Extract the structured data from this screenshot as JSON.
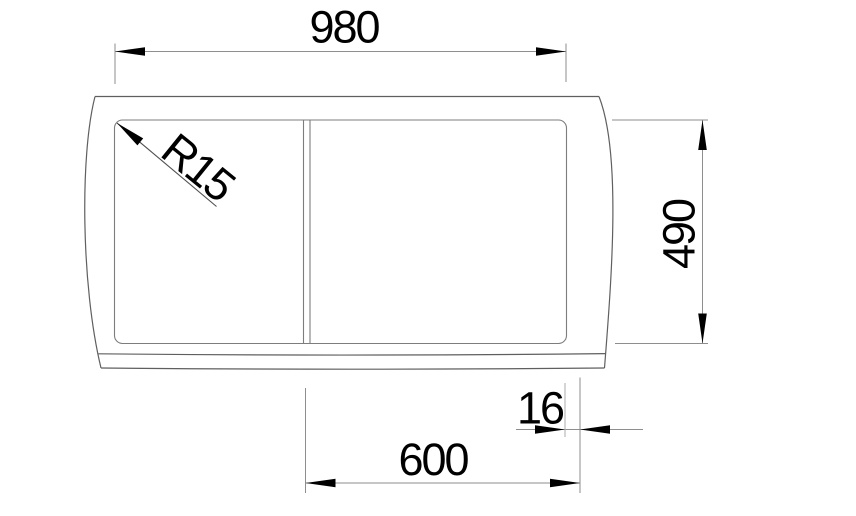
{
  "drawing": {
    "labels": {
      "overall_width": "980",
      "overall_depth": "490",
      "corner_radius": "R15",
      "edge_offset": "16",
      "bowl_width": "600"
    },
    "colors": {
      "background": "#ffffff",
      "outline": "#5f5f5f",
      "bowl_outline": "#7d7d7d",
      "dimension_lines": "#8e8e8e",
      "light_extension": "#ababab",
      "leader": "#4f4f4f",
      "text": "#000000"
    }
  }
}
